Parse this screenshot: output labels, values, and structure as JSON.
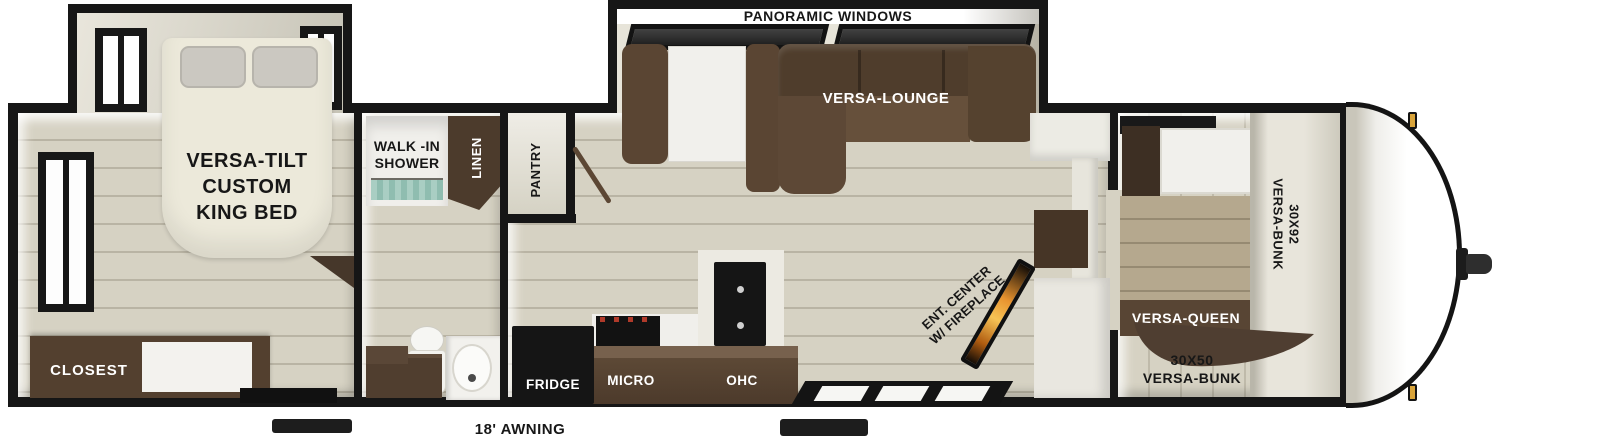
{
  "labels": {
    "panoramic_windows": "PANORAMIC WINDOWS",
    "versa_lounge": "VERSA-LOUNGE",
    "king_bed": [
      "VERSA-TILT",
      "CUSTOM",
      "KING BED"
    ],
    "closet": "CLOSEST",
    "shower": [
      "WALK -IN",
      "SHOWER"
    ],
    "linen": "LINEN",
    "pantry": "PANTRY",
    "fridge": "FRIDGE",
    "micro": "MICRO",
    "ohc": "OHC",
    "ent_center": [
      "ENT. CENTER",
      "W/ FIREPLACE"
    ],
    "bunk_30x92": [
      "30X92",
      "VERSA-BUNK"
    ],
    "versa_queen": "VERSA-QUEEN",
    "bunk_30x50": [
      "30X50",
      "VERSA-BUNK"
    ],
    "awning": "18' AWNING"
  },
  "colors": {
    "wall_black": "#161616",
    "floor_beige": "#d6d2c3",
    "furniture_brown": "#5a4533",
    "dark_brown": "#4a3a2c",
    "bed_cream": "#ece9da",
    "marker_amber": "#d9a43a",
    "fireplace_orange": "#f0932b",
    "shower_tile_teal": "#a9cec3"
  }
}
